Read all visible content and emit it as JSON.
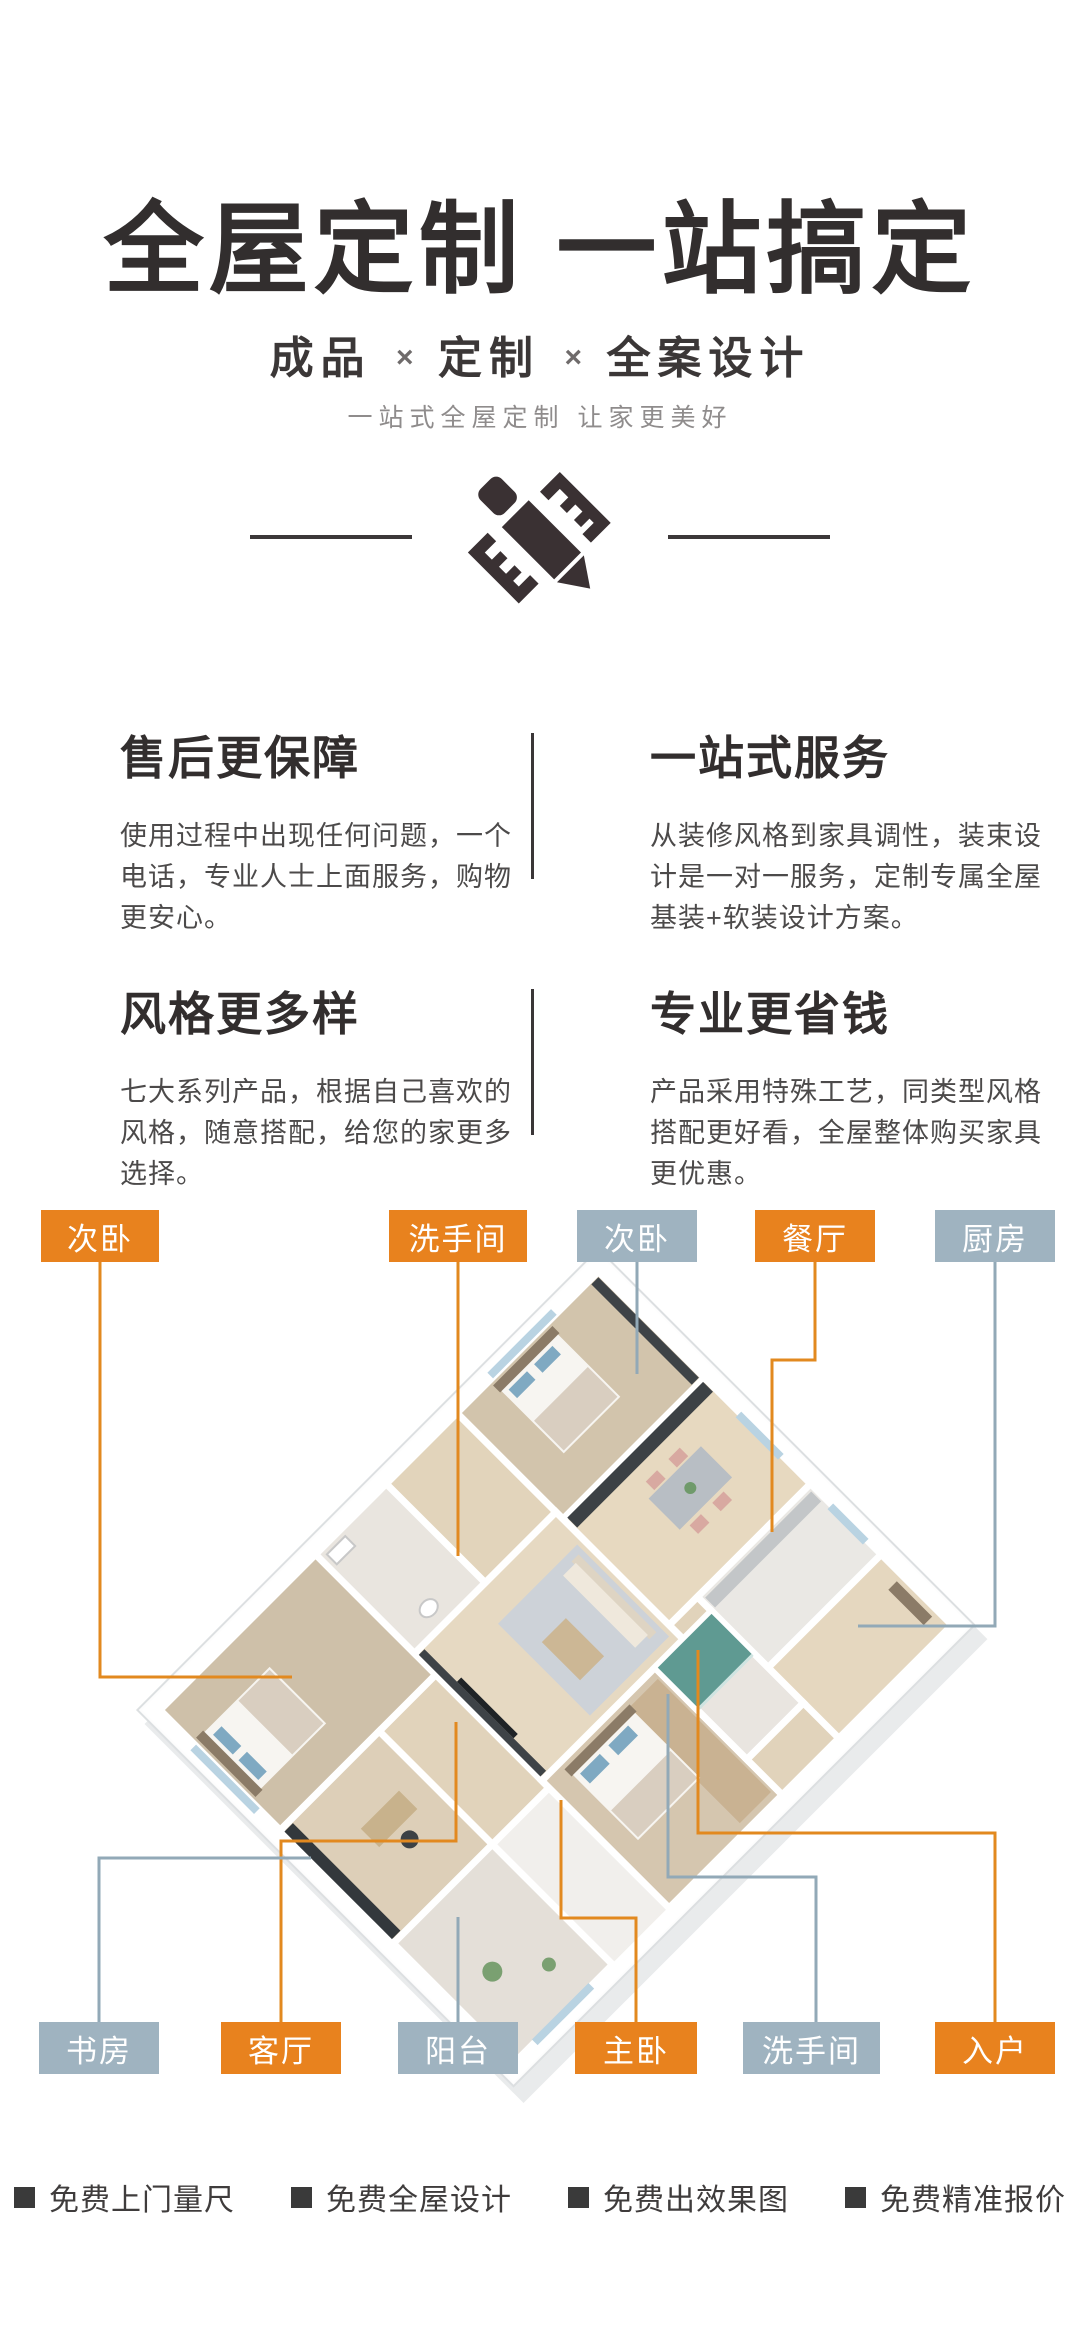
{
  "header": {
    "title": "全屋定制 一站搞定",
    "subtitle_parts": [
      "成品",
      "定制",
      "全案设计"
    ],
    "subtitle_separator": "×",
    "tagline": "一站式全屋定制 让家更美好"
  },
  "features": [
    {
      "title": "售后更保障",
      "desc": "使用过程中出现任何问题，一个电话，专业人士上面服务，购物更安心。"
    },
    {
      "title": "一站式服务",
      "desc": "从装修风格到家具调性，装束设计是一对一服务，定制专属全屋基装+软装设计方案。"
    },
    {
      "title": "风格更多样",
      "desc": "七大系列产品，根据自己喜欢的风格，随意搭配，给您的家更多选择。"
    },
    {
      "title": "专业更省钱",
      "desc": "产品采用特殊工艺，同类型风格搭配更好看，全屋整体购买家具更优惠。"
    }
  ],
  "floorplan": {
    "labels_top": [
      {
        "text": "次卧",
        "style": "orange"
      },
      {
        "text": "洗手间",
        "style": "orange"
      },
      {
        "text": "次卧",
        "style": "gray"
      },
      {
        "text": "餐厅",
        "style": "orange"
      },
      {
        "text": "厨房",
        "style": "gray"
      }
    ],
    "labels_bottom": [
      {
        "text": "书房",
        "style": "gray"
      },
      {
        "text": "客厅",
        "style": "orange"
      },
      {
        "text": "阳台",
        "style": "gray"
      },
      {
        "text": "主卧",
        "style": "orange"
      },
      {
        "text": "洗手间",
        "style": "gray"
      },
      {
        "text": "入户",
        "style": "orange"
      }
    ],
    "colors": {
      "label_orange": "#e8821e",
      "label_gray": "#9fb3c0",
      "line_orange": "#e2891f",
      "line_gray": "#92a9b7"
    }
  },
  "footer": {
    "items": [
      "免费上门量尺",
      "免费全屋设计",
      "免费出效果图",
      "免费精准报价"
    ]
  }
}
